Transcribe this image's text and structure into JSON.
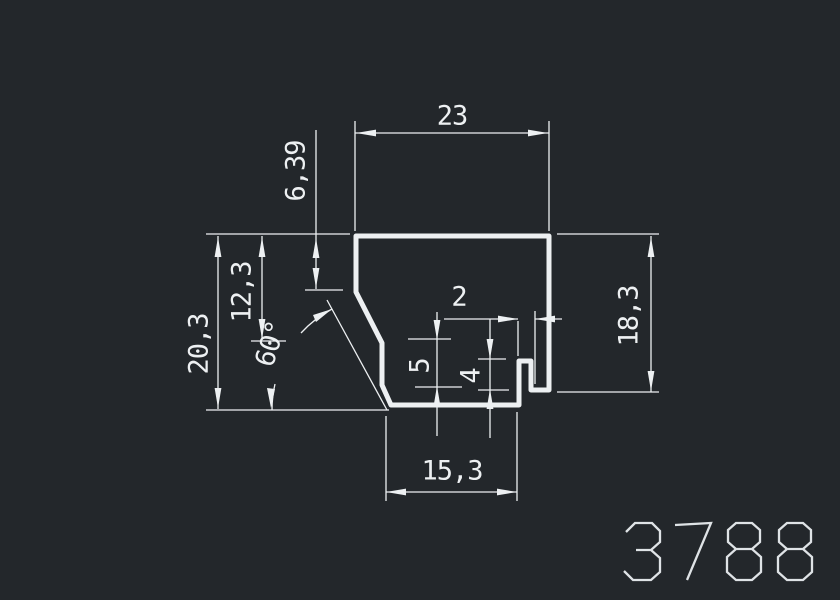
{
  "drawing": {
    "part_number": "3788",
    "dimensions": {
      "top_width": "23",
      "chamfer_start_depth": "6,39",
      "left_chamfer_end_depth": "12,3",
      "total_height": "20,3",
      "chamfer_angle": "60°",
      "lower_left_height": "5",
      "hook_tab_width": "2",
      "hook_tab_height": "4",
      "right_side_height": "18,3",
      "bottom_width": "15,3"
    },
    "colors": {
      "background": "#23272b",
      "line": "#edf0f2",
      "part_number_color": "#dfe3e6"
    }
  }
}
